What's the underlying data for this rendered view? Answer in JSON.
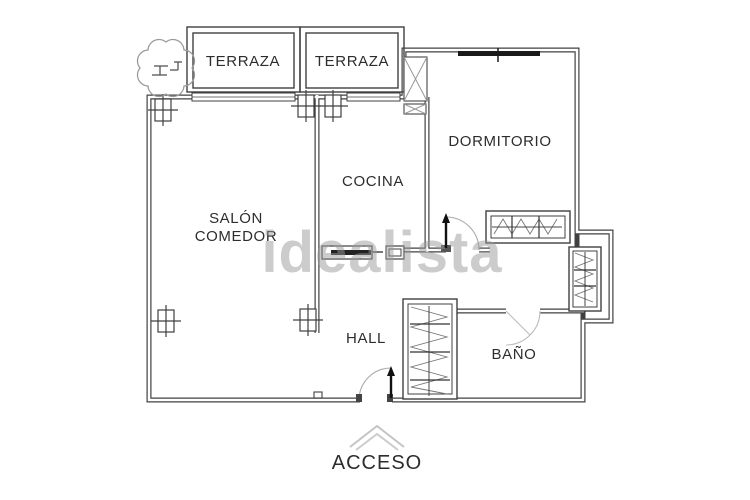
{
  "page": {
    "background": "#ffffff"
  },
  "room_labels": {
    "terraza_left": "TERRAZA",
    "terraza_right": "TERRAZA",
    "dormitorio": "DORMITORIO",
    "cocina": "COCINA",
    "salon_line1": "SALÓN",
    "salon_line2": "COMEDOR",
    "hall": "HALL",
    "bano": "BAÑO"
  },
  "entrance": {
    "label": "ACCESO"
  },
  "watermark": {
    "text": "idealista"
  },
  "symbols": {
    "tree": "tree-icon",
    "shaft": "x-crossed-shaft-icon",
    "wardrobe": "hatched-wardrobe-icon",
    "door": "door-swing-arrow-icon",
    "window": "window-bar-icon",
    "column_marker": "crosshatch-column-marker-icon",
    "access_chevron": "chevron-up-icon"
  },
  "colors": {
    "wall": "#404040",
    "light_gray": "#aaaaaa",
    "watermark_gray": "#9a9a9a",
    "label": "#2d2d2d"
  }
}
